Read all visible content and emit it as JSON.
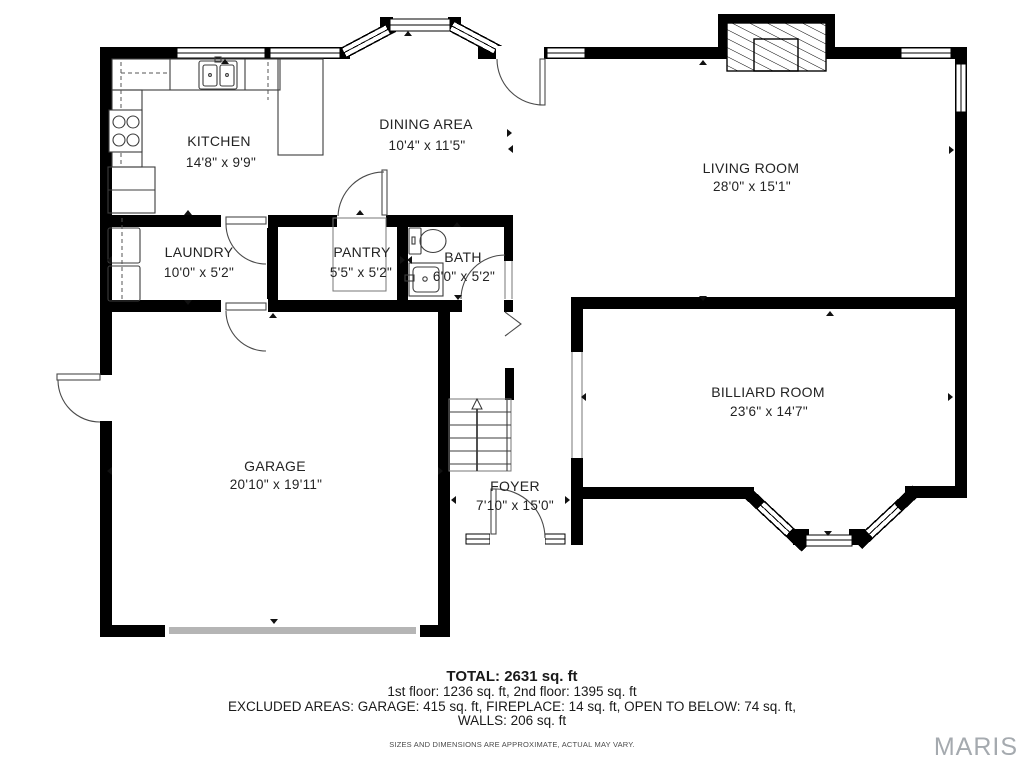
{
  "watermark": "MARIS",
  "rooms": {
    "kitchen": {
      "name": "KITCHEN",
      "dims": "14'8\" x 9'9\""
    },
    "dining": {
      "name": "DINING AREA",
      "dims": "10'4\" x 11'5\""
    },
    "living": {
      "name": "LIVING ROOM",
      "dims": "28'0\" x 15'1\""
    },
    "laundry": {
      "name": "LAUNDRY",
      "dims": "10'0\" x 5'2\""
    },
    "pantry": {
      "name": "PANTRY",
      "dims": "5'5\" x 5'2\""
    },
    "bath": {
      "name": "BATH",
      "dims": "6'0\" x 5'2\""
    },
    "garage": {
      "name": "GARAGE",
      "dims": "20'10\" x 19'11\""
    },
    "foyer": {
      "name": "FOYER",
      "dims": "7'10\" x 15'0\""
    },
    "billiard": {
      "name": "BILLIARD ROOM",
      "dims": "23'6\" x 14'7\""
    }
  },
  "summary": {
    "total": "TOTAL: 2631 sq. ft",
    "floors": "1st floor: 1236 sq. ft, 2nd floor: 1395 sq. ft",
    "excluded": "EXCLUDED AREAS: GARAGE: 415 sq. ft, FIREPLACE: 14 sq. ft, OPEN TO BELOW: 74 sq. ft,",
    "walls": "WALLS: 206 sq. ft",
    "disclaimer": "SIZES AND DIMENSIONS ARE APPROXIMATE, ACTUAL MAY VARY."
  },
  "colors": {
    "wall": "#000000",
    "garage_door": "#b5b5b5",
    "watermark_gray": "#a5aaaf"
  }
}
